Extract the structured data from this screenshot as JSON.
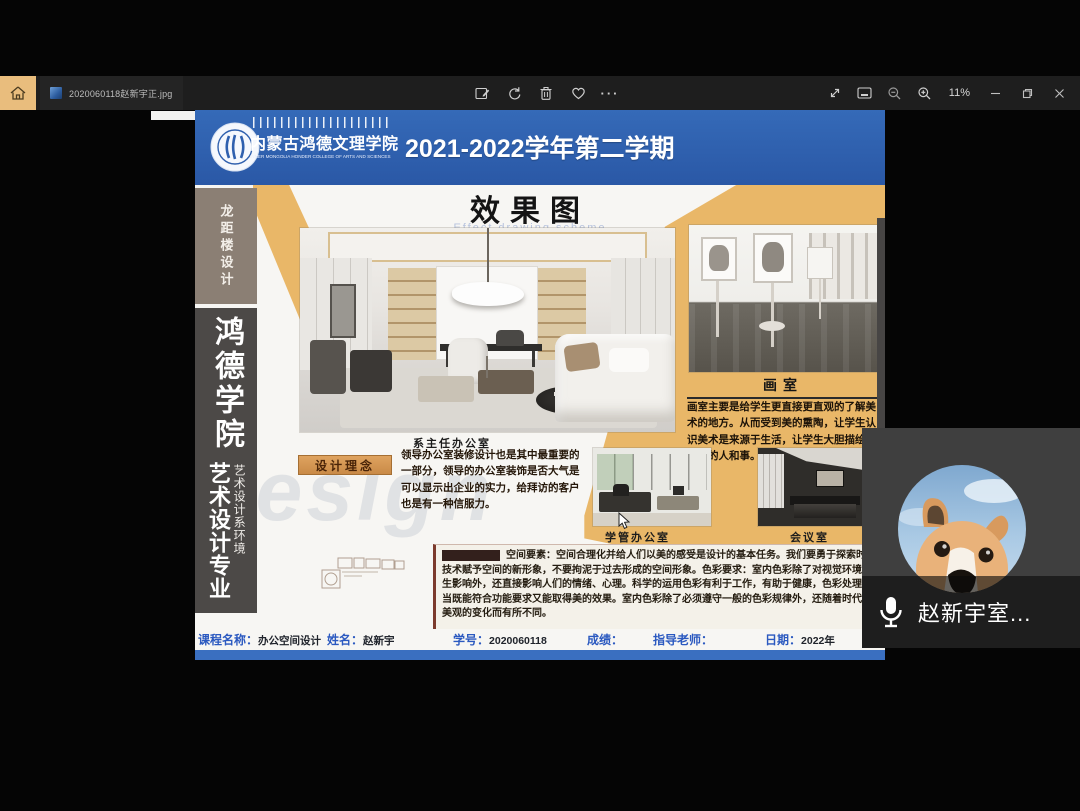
{
  "titlebar": {
    "filename": "2020060118赵新宇正.jpg",
    "zoom_level": "11%",
    "more_label": "···",
    "icons": [
      "home",
      "edit",
      "rotate",
      "delete",
      "favorite",
      "more",
      "fullscreen",
      "fit-window",
      "zoom-out",
      "zoom-in",
      "minimize",
      "maximize",
      "close"
    ]
  },
  "poster": {
    "header": {
      "college_cn": "内蒙古鸿德文理学院",
      "college_en": "INNER MONGOLIA HONDER COLLEGE OF ARTS AND SCIENCES",
      "semester": "2021-2022学年第二学期"
    },
    "sidebar": {
      "project": "龙距楼设计",
      "college": "鸿德学院",
      "dept": "艺术设计系环境",
      "major": "艺术设计专业"
    },
    "section_title": "效果图",
    "section_subtitle_en": "Effect drawing scheme",
    "watermark": "Design",
    "captions": {
      "main_render": "系主任办公室",
      "studio": "画室",
      "admin_office": "学管办公室",
      "meeting_room": "会议室"
    },
    "concept": {
      "label": "设计理念",
      "text": "领导办公室装修设计也是其中最重要的一部分，领导的办公室装饰是否大气是可以显示出企业的实力，给拜访的客户也是有一种信服力。"
    },
    "studio_text": "画室主要是给学生更直接更直观的了解美术的地方。从而受到美的熏陶，让学生认识美术是来源于生活，让学生大胆描绘生活中的人和事。",
    "description_text": "空间要素：空间合理化并给人们以美的感受是设计的基本任务。我们要勇于探索时代技术赋予空间的新形象，不要拘泥于过去形成的空间形象。色彩要求：室内色彩除了对视觉环境产生影响外，还直接影响人们的情绪、心理。科学的运用色彩有利于工作，有助于健康，色彩处理得当既能符合功能要求又能取得美的效果。室内色彩除了必须遵守一般的色彩规律外，还随着时代审美观的变化而有所不同。",
    "footer": {
      "course_label": "课程名称：",
      "course_value": "办公空间设计",
      "name_label": "姓名：",
      "name_value": "赵新宇",
      "sid_label": "学号：",
      "sid_value": "2020060118",
      "grade_label": "成绩：",
      "teacher_label": "指导老师：",
      "date_label": "日期：",
      "date_value": "2022年"
    },
    "accent_colors": {
      "header_blue": "#2f60ae",
      "orange": "#e9b768",
      "sidebar_dark": "#4c4947",
      "sidebar_taupe": "#8b7f74"
    }
  },
  "call_overlay": {
    "participant_name": "赵新宇室..."
  }
}
